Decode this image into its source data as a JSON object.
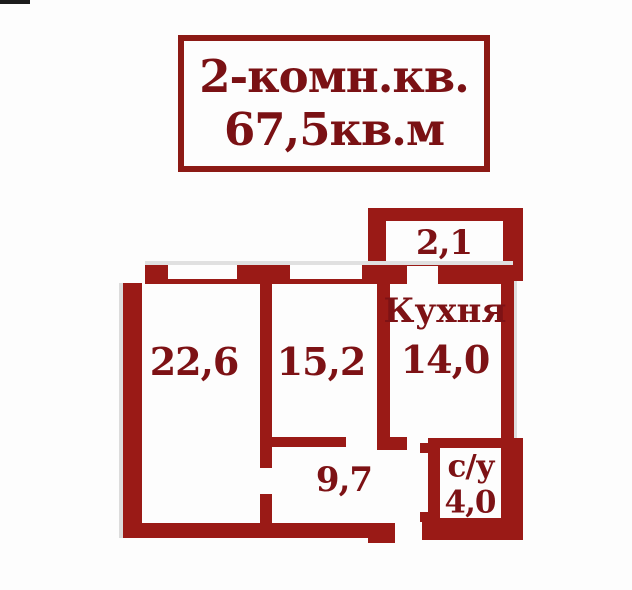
{
  "title_card": {
    "line1": "2-комн.кв.",
    "line2": "67,5кв.м"
  },
  "rooms": {
    "balcony": {
      "area": "2,1"
    },
    "living": {
      "area": "22,6"
    },
    "bedroom": {
      "area": "15,2"
    },
    "kitchen": {
      "name": "Кухня",
      "area": "14,0"
    },
    "hallway": {
      "area": "9,7"
    },
    "bathroom": {
      "name": "с/у",
      "area": "4,0"
    }
  },
  "colors": {
    "wall": "#9a1a16",
    "label": "#7d1215",
    "title": "#7a1114",
    "border": "#8c1a15",
    "bg": "#fdfdfd"
  }
}
